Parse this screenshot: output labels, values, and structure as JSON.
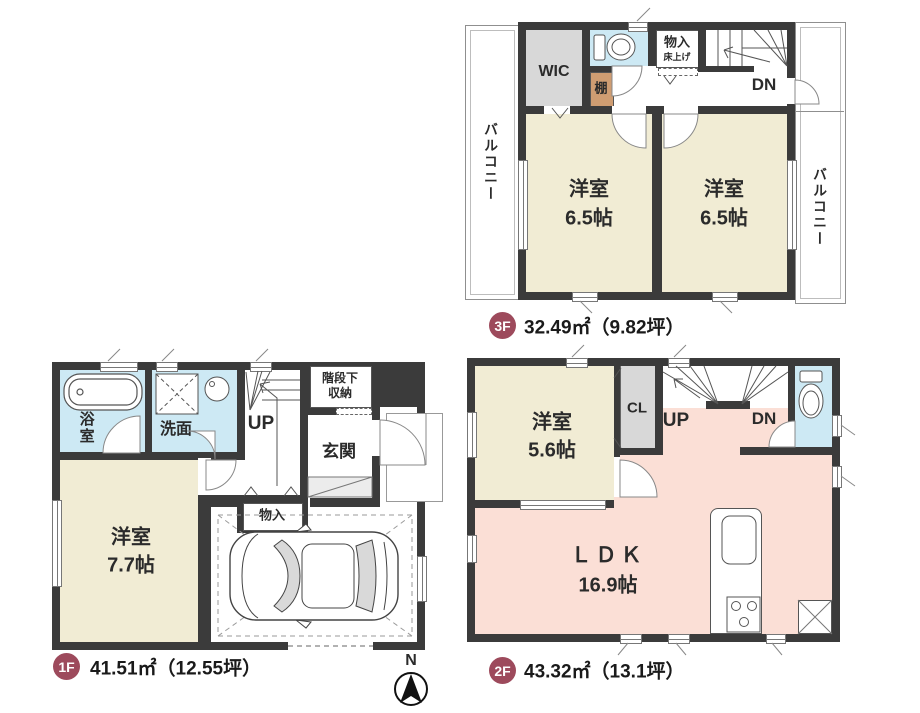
{
  "colors": {
    "wall": "#3b3b3b",
    "room_cream": "#f1ecd4",
    "room_pink": "#fbdfd6",
    "wet_blue": "#cde9f4",
    "closet_gray": "#d8d8d8",
    "shelf_tan": "#cf9d72",
    "badge": "#9d4a5c"
  },
  "compass_label": "N",
  "floor3": {
    "badge": "3F",
    "area_text": "32.49㎡（9.82坪）",
    "balcony_left": "バルコニー",
    "balcony_right": "バルコニー",
    "wic_label": "WIC",
    "shelf_label": "棚",
    "storage_label": "物入",
    "storage_sub_label": "床上げ",
    "dn_label": "DN",
    "room_left_name": "洋室",
    "room_left_size": "6.5帖",
    "room_right_name": "洋室",
    "room_right_size": "6.5帖"
  },
  "floor1": {
    "badge": "1F",
    "area_text": "41.51㎡（12.55坪）",
    "bath_label": "浴室",
    "washroom_label": "洗面",
    "up_label": "UP",
    "understair_line1": "階段下",
    "understair_line2": "収納",
    "entrance_label": "玄関",
    "storage_label": "物入",
    "room_name": "洋室",
    "room_size": "7.7帖"
  },
  "floor2": {
    "badge": "2F",
    "area_text": "43.32㎡（13.1坪）",
    "closet_label": "CL",
    "up_label": "UP",
    "dn_label": "DN",
    "room_name": "洋室",
    "room_size": "5.6帖",
    "ldk_name": "ＬＤＫ",
    "ldk_size": "16.9帖"
  }
}
